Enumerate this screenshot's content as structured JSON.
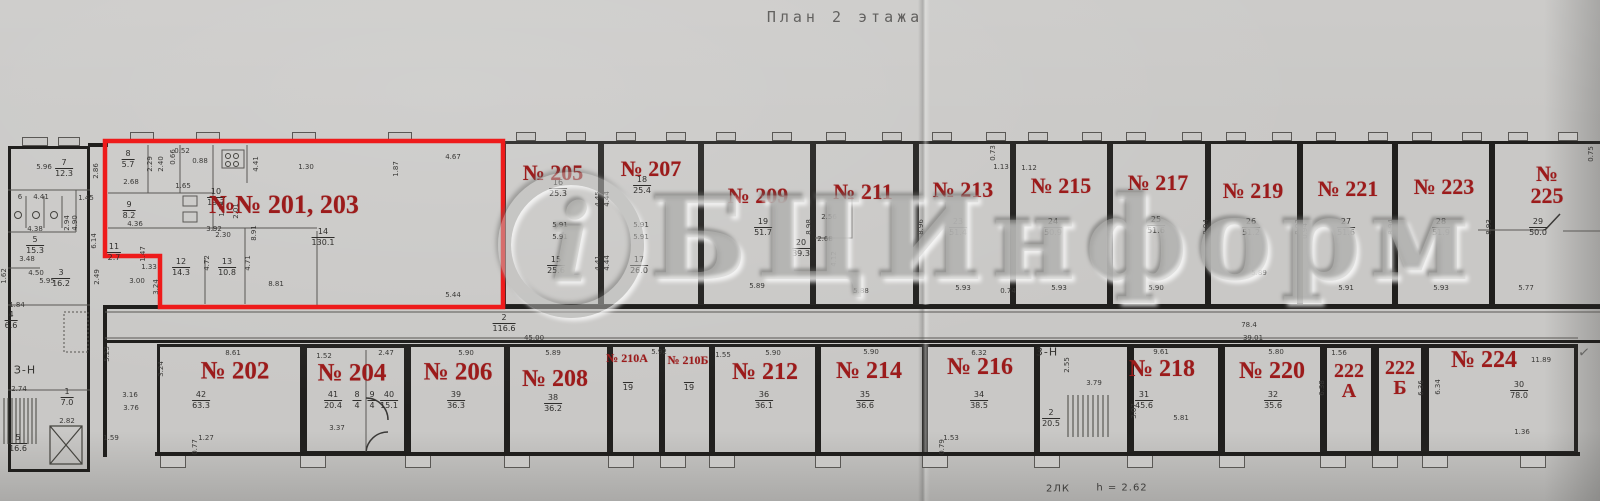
{
  "title": "План 2 этажа",
  "watermark": {
    "logo": "i",
    "text": "БЦИнформ"
  },
  "footer": {
    "stairs": "2ЛК",
    "height": "h = 2.62"
  },
  "check": "✓",
  "zones": [
    {
      "t": "З-Н",
      "x": 25,
      "y": 370
    },
    {
      "t": "3-Н",
      "x": 1047,
      "y": 352
    }
  ],
  "rooms": [
    {
      "name": "room-201-203",
      "label": "№№ 201, 203",
      "lx": 284,
      "ly": 205,
      "fs": 26
    },
    {
      "name": "room-205",
      "label": "№ 205",
      "box": [
        503,
        141,
        98,
        166
      ],
      "lx": 553,
      "ly": 173,
      "fs": 22
    },
    {
      "name": "room-207",
      "label": "№ 207",
      "box": [
        601,
        141,
        100,
        166
      ],
      "lx": 651,
      "ly": 169,
      "fs": 22
    },
    {
      "name": "room-209",
      "label": "№ 209",
      "box": [
        701,
        141,
        112,
        166
      ],
      "lx": 758,
      "ly": 196,
      "fs": 22
    },
    {
      "name": "room-211",
      "label": "№ 211",
      "box": [
        813,
        141,
        103,
        166
      ],
      "lx": 863,
      "ly": 192,
      "fs": 22
    },
    {
      "name": "room-213",
      "label": "№ 213",
      "box": [
        916,
        141,
        97,
        166
      ],
      "lx": 963,
      "ly": 190,
      "fs": 22
    },
    {
      "name": "room-215",
      "label": "№ 215",
      "box": [
        1013,
        141,
        97,
        166
      ],
      "lx": 1061,
      "ly": 186,
      "fs": 22
    },
    {
      "name": "room-217",
      "label": "№ 217",
      "box": [
        1110,
        141,
        98,
        166
      ],
      "lx": 1158,
      "ly": 183,
      "fs": 22
    },
    {
      "name": "room-219",
      "label": "№ 219",
      "box": [
        1208,
        141,
        92,
        166
      ],
      "lx": 1253,
      "ly": 191,
      "fs": 22
    },
    {
      "name": "room-221",
      "label": "№ 221",
      "box": [
        1300,
        141,
        95,
        166
      ],
      "lx": 1348,
      "ly": 189,
      "fs": 22
    },
    {
      "name": "room-223",
      "label": "№ 223",
      "box": [
        1395,
        141,
        97,
        166
      ],
      "lx": 1444,
      "ly": 187,
      "fs": 22
    },
    {
      "name": "room-225",
      "label": "№ 225",
      "box": [
        1492,
        141,
        112,
        166
      ],
      "lx": 1547,
      "ly": 185,
      "fs": 22
    },
    {
      "name": "room-202",
      "label": "№ 202",
      "box": [
        157,
        344,
        146,
        111
      ],
      "lx": 235,
      "ly": 371,
      "fs": 25
    },
    {
      "name": "room-204",
      "label": "№ 204",
      "box": [
        303,
        344,
        105,
        111
      ],
      "lx": 352,
      "ly": 373,
      "fs": 25,
      "heavy": true
    },
    {
      "name": "room-206",
      "label": "№ 206",
      "box": [
        408,
        344,
        99,
        111
      ],
      "lx": 458,
      "ly": 372,
      "fs": 25
    },
    {
      "name": "room-208",
      "label": "№ 208",
      "box": [
        507,
        344,
        103,
        111
      ],
      "lx": 555,
      "ly": 379,
      "fs": 24
    },
    {
      "name": "room-210a",
      "label": "№ 210А",
      "box": [
        610,
        344,
        52,
        111
      ],
      "lx": 627,
      "ly": 358,
      "fs": 12
    },
    {
      "name": "room-210b",
      "label": "№ 210Б",
      "box": [
        662,
        344,
        50,
        111
      ],
      "lx": 688,
      "ly": 360,
      "fs": 12
    },
    {
      "name": "room-212",
      "label": "№ 212",
      "box": [
        712,
        344,
        106,
        111
      ],
      "lx": 765,
      "ly": 372,
      "fs": 24
    },
    {
      "name": "room-214",
      "label": "№ 214",
      "box": [
        818,
        344,
        107,
        111
      ],
      "lx": 869,
      "ly": 371,
      "fs": 24
    },
    {
      "name": "room-216",
      "label": "№ 216",
      "box": [
        925,
        344,
        112,
        111
      ],
      "lx": 980,
      "ly": 367,
      "fs": 24
    },
    {
      "name": "stairwell-3n",
      "label": "",
      "box": [
        1037,
        344,
        93,
        111
      ],
      "lx": 0,
      "ly": 0,
      "fs": 10
    },
    {
      "name": "room-218",
      "label": "№ 218",
      "box": [
        1130,
        344,
        92,
        111
      ],
      "lx": 1162,
      "ly": 369,
      "fs": 24,
      "heavy": true
    },
    {
      "name": "room-220",
      "label": "№ 220",
      "box": [
        1222,
        344,
        101,
        111
      ],
      "lx": 1272,
      "ly": 371,
      "fs": 24
    },
    {
      "name": "room-222a",
      "label": "222\nА",
      "box": [
        1323,
        344,
        52,
        111
      ],
      "lx": 1349,
      "ly": 381,
      "fs": 20,
      "heavy": true
    },
    {
      "name": "room-222b",
      "label": "222\nБ",
      "box": [
        1375,
        344,
        50,
        111
      ],
      "lx": 1400,
      "ly": 378,
      "fs": 20,
      "heavy": true
    },
    {
      "name": "room-224",
      "label": "№ 224",
      "box": [
        1425,
        344,
        153,
        111
      ],
      "lx": 1484,
      "ly": 360,
      "fs": 24,
      "heavy": true
    }
  ],
  "fracs": [
    [
      "8",
      "5.7",
      128,
      150
    ],
    [
      "9",
      "8.2",
      129,
      201
    ],
    [
      "11",
      "2.7",
      114,
      243
    ],
    [
      "10",
      "19.7",
      216,
      188
    ],
    [
      "12",
      "14.3",
      181,
      258
    ],
    [
      "13",
      "10.8",
      227,
      258
    ],
    [
      "14",
      "130.1",
      323,
      228
    ],
    [
      "16",
      "25.3",
      558,
      179
    ],
    [
      "15",
      "25.6",
      556,
      256
    ],
    [
      "18",
      "25.4",
      642,
      176
    ],
    [
      "17",
      "26.0",
      639,
      256
    ],
    [
      "19",
      "51.7",
      763,
      218
    ],
    [
      "20",
      "39.3",
      801,
      239
    ],
    [
      "23",
      "51.4",
      958,
      218
    ],
    [
      "24",
      "50.9",
      1053,
      218
    ],
    [
      "25",
      "51.6",
      1156,
      216
    ],
    [
      "26",
      "51.2",
      1251,
      218
    ],
    [
      "27",
      "51.6",
      1346,
      218
    ],
    [
      "28",
      "51.9",
      1441,
      218
    ],
    [
      "29",
      "50.0",
      1538,
      218
    ],
    [
      "42",
      "63.3",
      201,
      391
    ],
    [
      "41",
      "20.4",
      333,
      391
    ],
    [
      "8",
      "4",
      357,
      391
    ],
    [
      "9",
      "4",
      372,
      391
    ],
    [
      "40",
      "15.1",
      389,
      391
    ],
    [
      "39",
      "36.3",
      456,
      391
    ],
    [
      "38",
      "36.2",
      553,
      394
    ],
    [
      "",
      "19",
      628,
      381
    ],
    [
      "",
      "19",
      689,
      381
    ],
    [
      "36",
      "36.1",
      764,
      391
    ],
    [
      "35",
      "36.6",
      865,
      391
    ],
    [
      "34",
      "38.5",
      979,
      391
    ],
    [
      "2",
      "20.5",
      1051,
      409
    ],
    [
      "31",
      "45.6",
      1144,
      391
    ],
    [
      "32",
      "35.6",
      1273,
      391
    ],
    [
      "30",
      "78.0",
      1519,
      381
    ],
    [
      "2",
      "116.6",
      504,
      314
    ],
    [
      "7",
      "12.3",
      64,
      159
    ],
    [
      "5",
      "15.3",
      35,
      236
    ],
    [
      "3",
      "16.2",
      61,
      269
    ],
    [
      "4",
      "6.6",
      11,
      311
    ],
    [
      "1",
      "7.0",
      67,
      388
    ],
    [
      "5",
      "16.6",
      18,
      434
    ]
  ],
  "marks": [
    [
      "5.96",
      44,
      167,
      0
    ],
    [
      "2.86",
      96,
      171,
      1
    ],
    [
      "6",
      20,
      197,
      0
    ],
    [
      "4.41",
      41,
      197,
      0
    ],
    [
      "1.45",
      86,
      198,
      0
    ],
    [
      "2.94",
      67,
      223,
      1
    ],
    [
      "4.90",
      75,
      223,
      1
    ],
    [
      "4.38",
      35,
      229,
      0
    ],
    [
      "3.48",
      27,
      259,
      0
    ],
    [
      "4.50",
      36,
      273,
      0
    ],
    [
      "5.95",
      47,
      281,
      0
    ],
    [
      "6.14",
      94,
      241,
      1
    ],
    [
      "1.62",
      4,
      276,
      1
    ],
    [
      "1.84",
      17,
      305,
      0
    ],
    [
      "2.74",
      19,
      389,
      0
    ],
    [
      "2.82",
      67,
      421,
      0
    ],
    [
      "5.23",
      107,
      354,
      1
    ],
    [
      "3.16",
      130,
      395,
      0
    ],
    [
      "3.76",
      131,
      408,
      0
    ],
    [
      "2.29",
      150,
      164,
      1
    ],
    [
      "2.40",
      161,
      164,
      1
    ],
    [
      "0.66",
      173,
      157,
      1
    ],
    [
      "0.52",
      182,
      151,
      0
    ],
    [
      "0.88",
      200,
      161,
      0
    ],
    [
      "2.68",
      131,
      182,
      0
    ],
    [
      "1.65",
      183,
      186,
      0
    ],
    [
      "1.88",
      222,
      209,
      1
    ],
    [
      "2.01",
      236,
      211,
      1
    ],
    [
      "4.36",
      135,
      224,
      0
    ],
    [
      "1.47",
      143,
      254,
      1
    ],
    [
      "1.33",
      149,
      267,
      0
    ],
    [
      "3.00",
      137,
      281,
      0
    ],
    [
      "3.92",
      214,
      229,
      0
    ],
    [
      "2.30",
      223,
      235,
      0
    ],
    [
      "8.91",
      254,
      233,
      1
    ],
    [
      "4.41",
      256,
      164,
      1
    ],
    [
      "1.30",
      306,
      167,
      0
    ],
    [
      "1.87",
      396,
      169,
      1
    ],
    [
      "4.67",
      453,
      157,
      0
    ],
    [
      "4.72",
      207,
      263,
      1
    ],
    [
      "4.71",
      248,
      263,
      1
    ],
    [
      "8.81",
      276,
      284,
      0
    ],
    [
      "5.44",
      453,
      295,
      0
    ],
    [
      "2.49",
      97,
      277,
      1
    ],
    [
      "3.24",
      156,
      287,
      1
    ],
    [
      "5.91",
      560,
      225,
      0
    ],
    [
      "5.91",
      560,
      237,
      0
    ],
    [
      "5.91",
      641,
      225,
      0
    ],
    [
      "5.91",
      641,
      237,
      0
    ],
    [
      "4.45",
      598,
      199,
      1
    ],
    [
      "4.44",
      607,
      199,
      1
    ],
    [
      "4.41",
      598,
      263,
      1
    ],
    [
      "4.44",
      607,
      263,
      1
    ],
    [
      "5.89",
      757,
      286,
      0
    ],
    [
      "8.98",
      809,
      227,
      1
    ],
    [
      "5.88",
      861,
      291,
      0
    ],
    [
      "8.96",
      921,
      227,
      1
    ],
    [
      "2.56",
      829,
      217,
      0
    ],
    [
      "2.68",
      825,
      239,
      0
    ],
    [
      "4.12",
      834,
      259,
      1
    ],
    [
      "0.73",
      993,
      153,
      1
    ],
    [
      "1.13",
      1001,
      167,
      0
    ],
    [
      "1.12",
      1029,
      168,
      0
    ],
    [
      "5.93",
      963,
      288,
      0
    ],
    [
      "0.74",
      1008,
      291,
      0
    ],
    [
      "5.93",
      1059,
      288,
      0
    ],
    [
      "8.95",
      1111,
      227,
      1
    ],
    [
      "5.90",
      1156,
      288,
      0
    ],
    [
      "8.94",
      1206,
      227,
      1
    ],
    [
      "5.89",
      1259,
      273,
      0
    ],
    [
      "8.93",
      1298,
      227,
      1
    ],
    [
      "0.94",
      1305,
      231,
      1
    ],
    [
      "5.91",
      1346,
      288,
      0
    ],
    [
      "8.94",
      1391,
      227,
      1
    ],
    [
      "5.93",
      1441,
      288,
      0
    ],
    [
      "8.93",
      1489,
      227,
      1
    ],
    [
      "5.77",
      1526,
      288,
      0
    ],
    [
      "0.75",
      1591,
      154,
      1
    ],
    [
      "45.00",
      534,
      338,
      0
    ],
    [
      "78.4",
      1249,
      325,
      0
    ],
    [
      "39.01",
      1253,
      338,
      0
    ],
    [
      "8.61",
      233,
      353,
      0
    ],
    [
      "3.24",
      161,
      369,
      1
    ],
    [
      "1.59",
      111,
      438,
      0
    ],
    [
      "1.27",
      206,
      438,
      0
    ],
    [
      "0.77",
      195,
      447,
      1
    ],
    [
      "1.52",
      324,
      356,
      0
    ],
    [
      "2.47",
      386,
      353,
      0
    ],
    [
      "3.37",
      337,
      428,
      0
    ],
    [
      "5.90",
      466,
      353,
      0
    ],
    [
      "5.89",
      553,
      353,
      0
    ],
    [
      "5.92",
      659,
      352,
      0
    ],
    [
      "1.55",
      723,
      355,
      0
    ],
    [
      "5.90",
      773,
      353,
      0
    ],
    [
      "5.90",
      871,
      352,
      0
    ],
    [
      "6.32",
      979,
      353,
      0
    ],
    [
      "1.53",
      951,
      438,
      0
    ],
    [
      "0.79",
      942,
      447,
      1
    ],
    [
      "2.55",
      1067,
      365,
      1
    ],
    [
      "3.79",
      1094,
      383,
      0
    ],
    [
      "9.61",
      1161,
      352,
      0
    ],
    [
      "3.07",
      1134,
      411,
      1
    ],
    [
      "5.81",
      1181,
      418,
      0
    ],
    [
      "5.80",
      1276,
      352,
      0
    ],
    [
      "1.56",
      1339,
      353,
      0
    ],
    [
      "6.38",
      1322,
      388,
      1
    ],
    [
      "6.36",
      1421,
      388,
      1
    ],
    [
      "11.89",
      1541,
      360,
      0
    ],
    [
      "6.34",
      1438,
      387,
      1
    ],
    [
      "1.36",
      1522,
      432,
      0
    ]
  ]
}
